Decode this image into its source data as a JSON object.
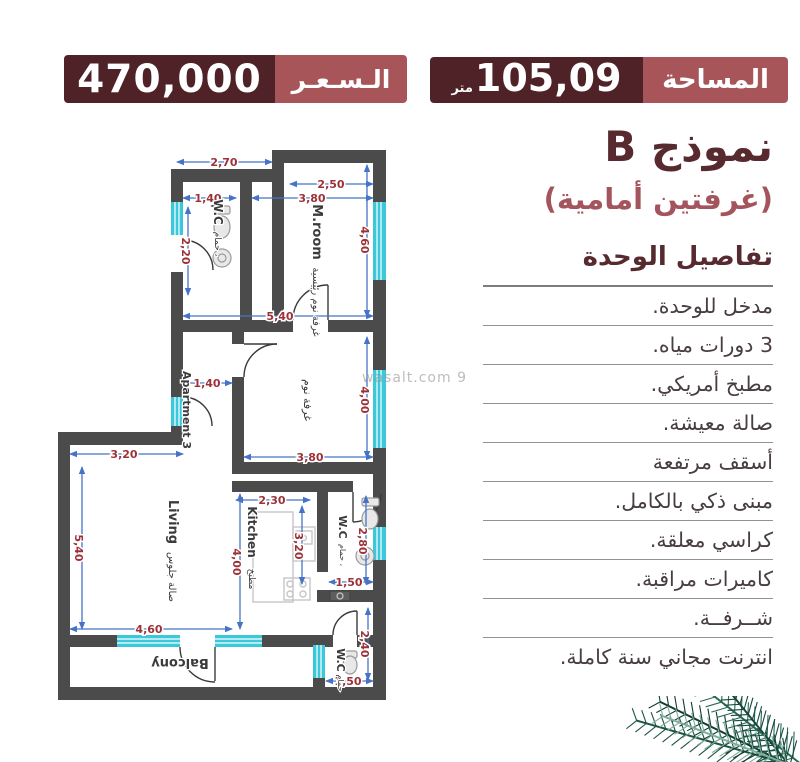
{
  "top": {
    "price": {
      "value": "470,000",
      "label": "الـسـعـر"
    },
    "area": {
      "value": "105,09",
      "unit": "متر",
      "label": "المساحة"
    }
  },
  "right_panel": {
    "model_title": "نموذج B",
    "model_subtitle": "(غرفتين أمامية)",
    "details_heading": "تفاصيل الوحدة",
    "features": [
      "مدخل للوحدة.",
      "3 دورات مياه.",
      "مطبخ أمريكي.",
      "صالة معيشة.",
      "أسقف مرتفعة",
      "مبنى ذكي بالكامل.",
      "كراسي معلقة.",
      "كاميرات مراقبة.",
      "شــرفــة.",
      "انترنت مجاني سنة كاملة."
    ]
  },
  "watermark": "wasalt.com 9",
  "floorplan": {
    "labels": {
      "wc_top": "W.C",
      "wc_top_ar": "حمام ،",
      "mroom": "M.room",
      "mroom_ar": "غرفة نوم رئيسية",
      "bedroom_ar": "غرفة نوم",
      "apartment": "Apartment 3",
      "living": "Living",
      "living_ar": "صالة جلوس",
      "kitchen": "Kitchen",
      "kitchen_ar": "مطبخ",
      "wc_mid": "W.C",
      "wc_mid_ar": "حمام ،",
      "wc_bottom": "W.C",
      "wc_bottom_ar": "حمام",
      "balcony": "Balcony"
    },
    "dims": {
      "d270": "2,70",
      "d250": "2,50",
      "d140_wc": "1,40",
      "d380_top": "3,80",
      "d220": "2,20",
      "d460_right": "4,60",
      "d540_top": "5,40",
      "d140_hall": "1,40",
      "d400_right": "4,00",
      "d380_bed": "3,80",
      "d230": "2,30",
      "d320_kitchen": "3,20",
      "d400_kitchen": "4,00",
      "d280": "2,80",
      "d150_wc": "1,50",
      "d320_living": "3,20",
      "d540_living": "5,40",
      "d460_bottom": "4,60",
      "d240": "2,40",
      "d150_bottom": "1,50"
    }
  },
  "colors": {
    "maroon_dark": "#4f2227",
    "maroon_light": "#a75559",
    "wall": "#4b4b4b",
    "window_cyan": "#3bc8da",
    "dim_blue": "#4673c8",
    "dim_red": "#9c3238"
  }
}
